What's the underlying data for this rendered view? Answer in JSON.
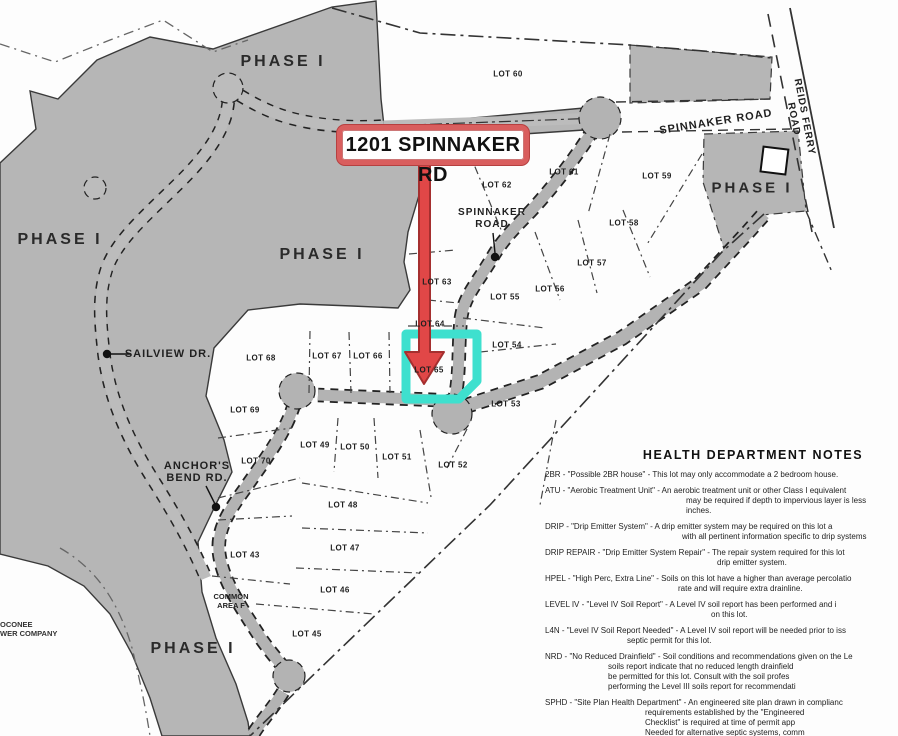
{
  "map": {
    "callout": {
      "label": "1201 SPINNAKER RD"
    },
    "highlight": {
      "lot": "LOT 65",
      "color": "#3EE0CE",
      "arrow_color": "#E14747"
    },
    "colors": {
      "phase_gray": "#b6b6b6",
      "road_gray": "#b3b3b3",
      "callout_red": "#d95e5e"
    },
    "phase_labels": [
      "PHASE I",
      "PHASE I",
      "PHASE I",
      "PHASE I",
      "PHASE I"
    ],
    "road_labels": {
      "spinnaker_top": "SPINNAKER ROAD",
      "reids_ferry": "REIDS FERRY ROAD",
      "spinnaker_mid": "SPINNAKER\nROAD",
      "sailview": "SAILVIEW DR.",
      "anchors_bend": "ANCHOR'S\nBEND RD."
    },
    "area_labels": {
      "common_area": "COMMON\nAREA F",
      "corner": "OCONEE\nWER COMPANY"
    },
    "lots": [
      {
        "label": "LOT 60",
        "x": 508,
        "y": 74
      },
      {
        "label": "LOT 61",
        "x": 564,
        "y": 172
      },
      {
        "label": "LOT 62",
        "x": 497,
        "y": 185
      },
      {
        "label": "LOT 59",
        "x": 657,
        "y": 176
      },
      {
        "label": "LOT 58",
        "x": 624,
        "y": 223
      },
      {
        "label": "LOT 57",
        "x": 592,
        "y": 263
      },
      {
        "label": "LOT 56",
        "x": 550,
        "y": 289
      },
      {
        "label": "LOT 55",
        "x": 505,
        "y": 297
      },
      {
        "label": "LOT 63",
        "x": 437,
        "y": 282
      },
      {
        "label": "LOT 64",
        "x": 430,
        "y": 324
      },
      {
        "label": "LOT 54",
        "x": 507,
        "y": 345
      },
      {
        "label": "LOT 65",
        "x": 429,
        "y": 370
      },
      {
        "label": "LOT 53",
        "x": 506,
        "y": 404
      },
      {
        "label": "LOT 66",
        "x": 368,
        "y": 356
      },
      {
        "label": "LOT 67",
        "x": 327,
        "y": 356
      },
      {
        "label": "LOT 68",
        "x": 261,
        "y": 358
      },
      {
        "label": "LOT 69",
        "x": 245,
        "y": 410
      },
      {
        "label": "LOT 70",
        "x": 256,
        "y": 461
      },
      {
        "label": "LOT 49",
        "x": 315,
        "y": 445
      },
      {
        "label": "LOT 50",
        "x": 355,
        "y": 447
      },
      {
        "label": "LOT 51",
        "x": 397,
        "y": 457
      },
      {
        "label": "LOT 52",
        "x": 453,
        "y": 465
      },
      {
        "label": "LOT 48",
        "x": 343,
        "y": 505
      },
      {
        "label": "LOT 47",
        "x": 345,
        "y": 548
      },
      {
        "label": "LOT 46",
        "x": 335,
        "y": 590
      },
      {
        "label": "LOT 43",
        "x": 245,
        "y": 555
      },
      {
        "label": "LOT 45",
        "x": 307,
        "y": 634
      }
    ]
  },
  "notes": {
    "title": "HEALTH DEPARTMENT NOTES",
    "items": [
      {
        "indent": 0,
        "lines": [
          "2BR  -  \"Possible 2BR house\"  -  This lot may only accommodate a 2 bedroom house."
        ]
      },
      {
        "indent": 141,
        "lines": [
          "ATU  -  \"Aerobic Treatment Unit\"  -  An aerobic treatment unit or other Class I equivalent",
          "may be required if depth to impervious layer is less",
          "inches."
        ]
      },
      {
        "indent": 137,
        "lines": [
          "DRIP  -  \"Drip Emitter System\"  -  A drip emitter system may be required on this lot a",
          "with all pertinent information specific to drip systems"
        ]
      },
      {
        "indent": 172,
        "lines": [
          "DRIP REPAIR  -  \"Drip Emitter System Repair\"  -  The repair system required for this lot",
          "drip emitter system."
        ]
      },
      {
        "indent": 133,
        "lines": [
          "HPEL  -  \"High Perc, Extra Line\"  -  Soils on this lot have a higher than average percolatio",
          "rate and will require extra drainline."
        ]
      },
      {
        "indent": 166,
        "lines": [
          "LEVEL IV  -  \"Level IV Soil Report\"  -  A Level IV soil report has been performed and i",
          "on this lot."
        ]
      },
      {
        "indent": 82,
        "lines": [
          "L4N  -  \"Level IV Soil Report Needed\"  -  A Level IV soil report will be needed prior to iss",
          "septic permit for this lot."
        ]
      },
      {
        "indent": 63,
        "lines": [
          "NRD  -  \"No Reduced Drainfield\"  -  Soil conditions and recommendations given on the Le",
          "soils report indicate that no reduced length drainfield",
          "be permitted for this lot. Consult with the soil profes",
          "performing the Level III soils report for recommendati"
        ]
      },
      {
        "indent": 100,
        "lines": [
          "SPHD  -  \"Site Plan Health Department\"  -  An engineered site plan drawn in complianc",
          "requirements established by the \"Engineered",
          "Checklist\" is required at time of permit app",
          "Needed for alternative septic systems, comm",
          "septic systems, and systems with high was",
          "or at discretion of local health authority."
        ]
      }
    ]
  }
}
